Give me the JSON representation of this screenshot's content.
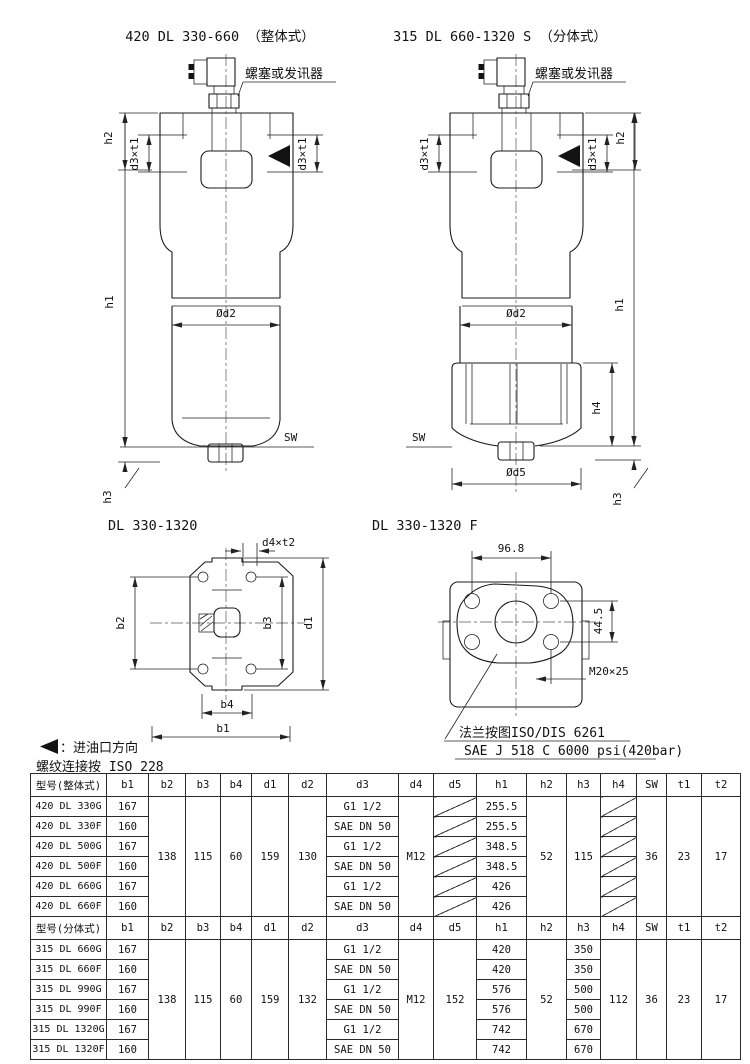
{
  "titles": {
    "integral": "420 DL 330-660 （整体式）",
    "split": "315 DL 660-1320 S （分体式）",
    "bottom_view": "DL 330-1320",
    "flange_view": "DL 330-1320 F"
  },
  "callouts": {
    "plug": "螺塞或发讯器"
  },
  "dim_labels": {
    "h1": "h1",
    "h2": "h2",
    "h3": "h3",
    "h4": "h4",
    "d3t1": "d3×t1",
    "od2": "Ød2",
    "od5": "Ød5",
    "sw": "SW",
    "d4t2": "d4×t2",
    "b1": "b1",
    "b2": "b2",
    "b3": "b3",
    "b4": "b4",
    "d1": "d1",
    "flange_width": "96.8",
    "flange_height": "44.5",
    "flange_thread": "M20×25"
  },
  "flange_notes": {
    "line1": "法兰按图ISO/DIS 6261",
    "line2": "SAE J 518 C 6000 psi(420bar)"
  },
  "footnotes": {
    "inlet_direction": "：进油口方向",
    "thread_standard": "螺纹连接按 ISO 228"
  },
  "tables": {
    "integral": {
      "header": [
        "型号(整体式)",
        "b1",
        "b2",
        "b3",
        "b4",
        "d1",
        "d2",
        "d3",
        "d4",
        "d5",
        "h1",
        "h2",
        "h3",
        "h4",
        "SW",
        "t1",
        "t2"
      ],
      "shared": {
        "b2": "138",
        "b3": "115",
        "b4": "60",
        "d1": "159",
        "d2": "130",
        "d4": "M12",
        "h2": "52",
        "h3": "115",
        "sw": "36",
        "t1": "23",
        "t2": "17"
      },
      "rows": [
        {
          "model": "420 DL 330G",
          "b1": "167",
          "d3": "G1 1/2",
          "h1": "255.5"
        },
        {
          "model": "420 DL 330F",
          "b1": "160",
          "d3": "SAE DN 50",
          "h1": "255.5"
        },
        {
          "model": "420 DL 500G",
          "b1": "167",
          "d3": "G1 1/2",
          "h1": "348.5"
        },
        {
          "model": "420 DL 500F",
          "b1": "160",
          "d3": "SAE DN 50",
          "h1": "348.5"
        },
        {
          "model": "420 DL 660G",
          "b1": "167",
          "d3": "G1 1/2",
          "h1": "426"
        },
        {
          "model": "420 DL 660F",
          "b1": "160",
          "d3": "SAE DN 50",
          "h1": "426"
        }
      ]
    },
    "split": {
      "header": [
        "型号(分体式)",
        "b1",
        "b2",
        "b3",
        "b4",
        "d1",
        "d2",
        "d3",
        "d4",
        "d5",
        "h1",
        "h2",
        "h3",
        "h4",
        "SW",
        "t1",
        "t2"
      ],
      "shared": {
        "b2": "138",
        "b3": "115",
        "b4": "60",
        "d1": "159",
        "d2": "132",
        "d4": "M12",
        "d5": "152",
        "h2": "52",
        "h4": "112",
        "sw": "36",
        "t1": "23",
        "t2": "17"
      },
      "rows": [
        {
          "model": "315 DL 660G",
          "b1": "167",
          "d3": "G1 1/2",
          "h1": "420",
          "h3": "350"
        },
        {
          "model": "315 DL 660F",
          "b1": "160",
          "d3": "SAE DN 50",
          "h1": "420",
          "h3": "350"
        },
        {
          "model": "315 DL 990G",
          "b1": "167",
          "d3": "G1 1/2",
          "h1": "576",
          "h3": "500"
        },
        {
          "model": "315 DL 990F",
          "b1": "160",
          "d3": "SAE DN 50",
          "h1": "576",
          "h3": "500"
        },
        {
          "model": "315 DL 1320G",
          "b1": "167",
          "d3": "G1 1/2",
          "h1": "742",
          "h3": "670"
        },
        {
          "model": "315 DL 1320F",
          "b1": "160",
          "d3": "SAE DN 50",
          "h1": "742",
          "h3": "670"
        }
      ]
    }
  }
}
